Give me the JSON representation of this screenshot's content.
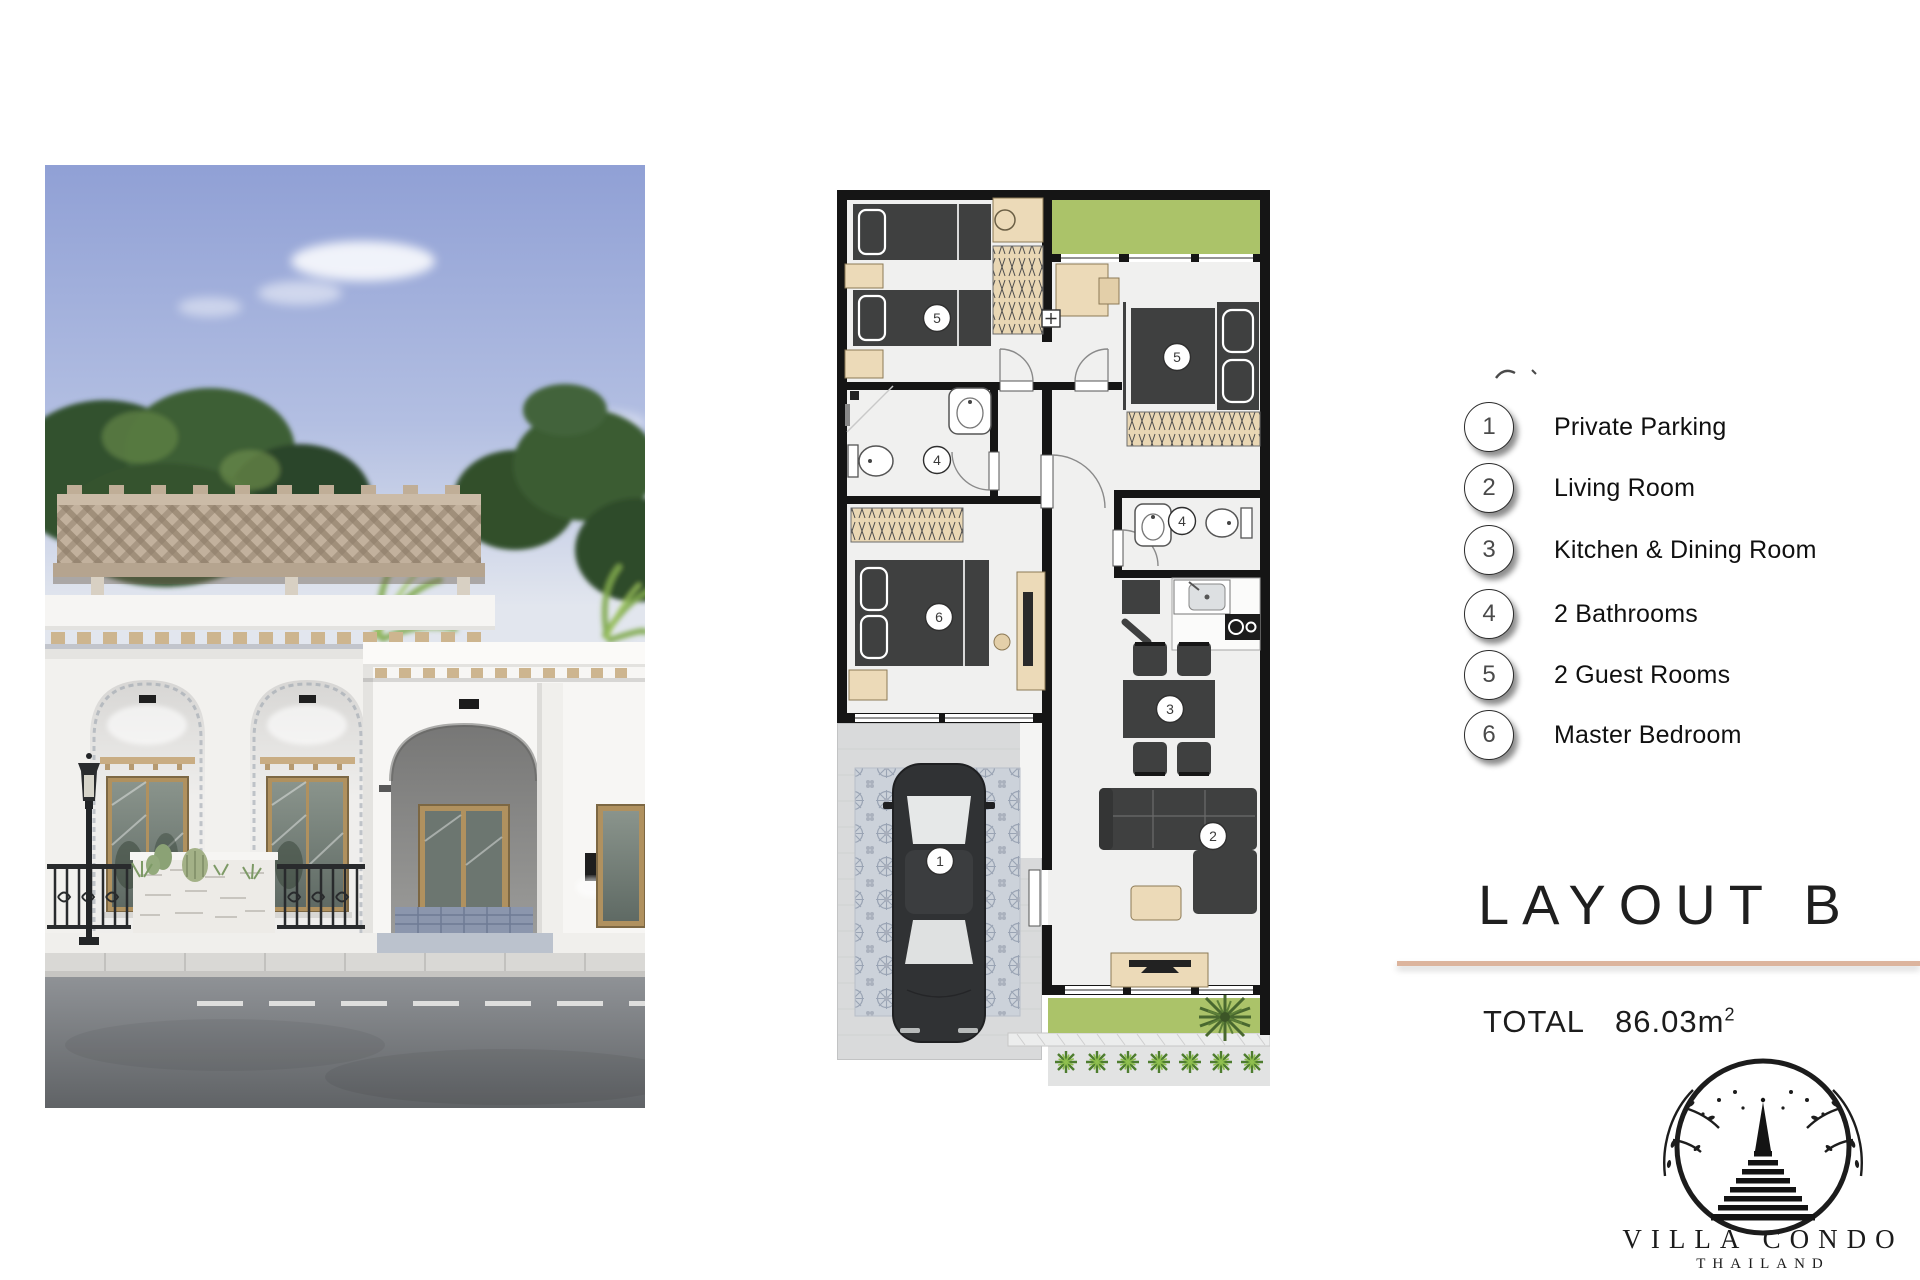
{
  "legend": {
    "items": [
      {
        "number": "1",
        "label": "Private Parking"
      },
      {
        "number": "2",
        "label": "Living Room"
      },
      {
        "number": "3",
        "label": "Kitchen & Dining Room"
      },
      {
        "number": "4",
        "label": "2 Bathrooms"
      },
      {
        "number": "5",
        "label": "2 Guest Rooms"
      },
      {
        "number": "6",
        "label": "Master Bedroom"
      }
    ]
  },
  "title": {
    "text": "LAYOUT B"
  },
  "total": {
    "label": "TOTAL",
    "value": "86.03m",
    "superscript": "2"
  },
  "logo": {
    "brand": "VILLA CONDO",
    "country": "THAILAND"
  },
  "floor_plan": {
    "markers": [
      {
        "number": "5"
      },
      {
        "number": "5"
      },
      {
        "number": "4"
      },
      {
        "number": "4"
      },
      {
        "number": "6"
      },
      {
        "number": "3"
      },
      {
        "number": "2"
      },
      {
        "number": "1"
      }
    ]
  },
  "colors": {
    "divider": "#dcb49d",
    "plan_green": "#abc369",
    "wall": "#151515",
    "wood": "#ead8b7",
    "dark_furniture": "#3f4040",
    "sky": "#90a0d5",
    "road": "#6d7074"
  }
}
